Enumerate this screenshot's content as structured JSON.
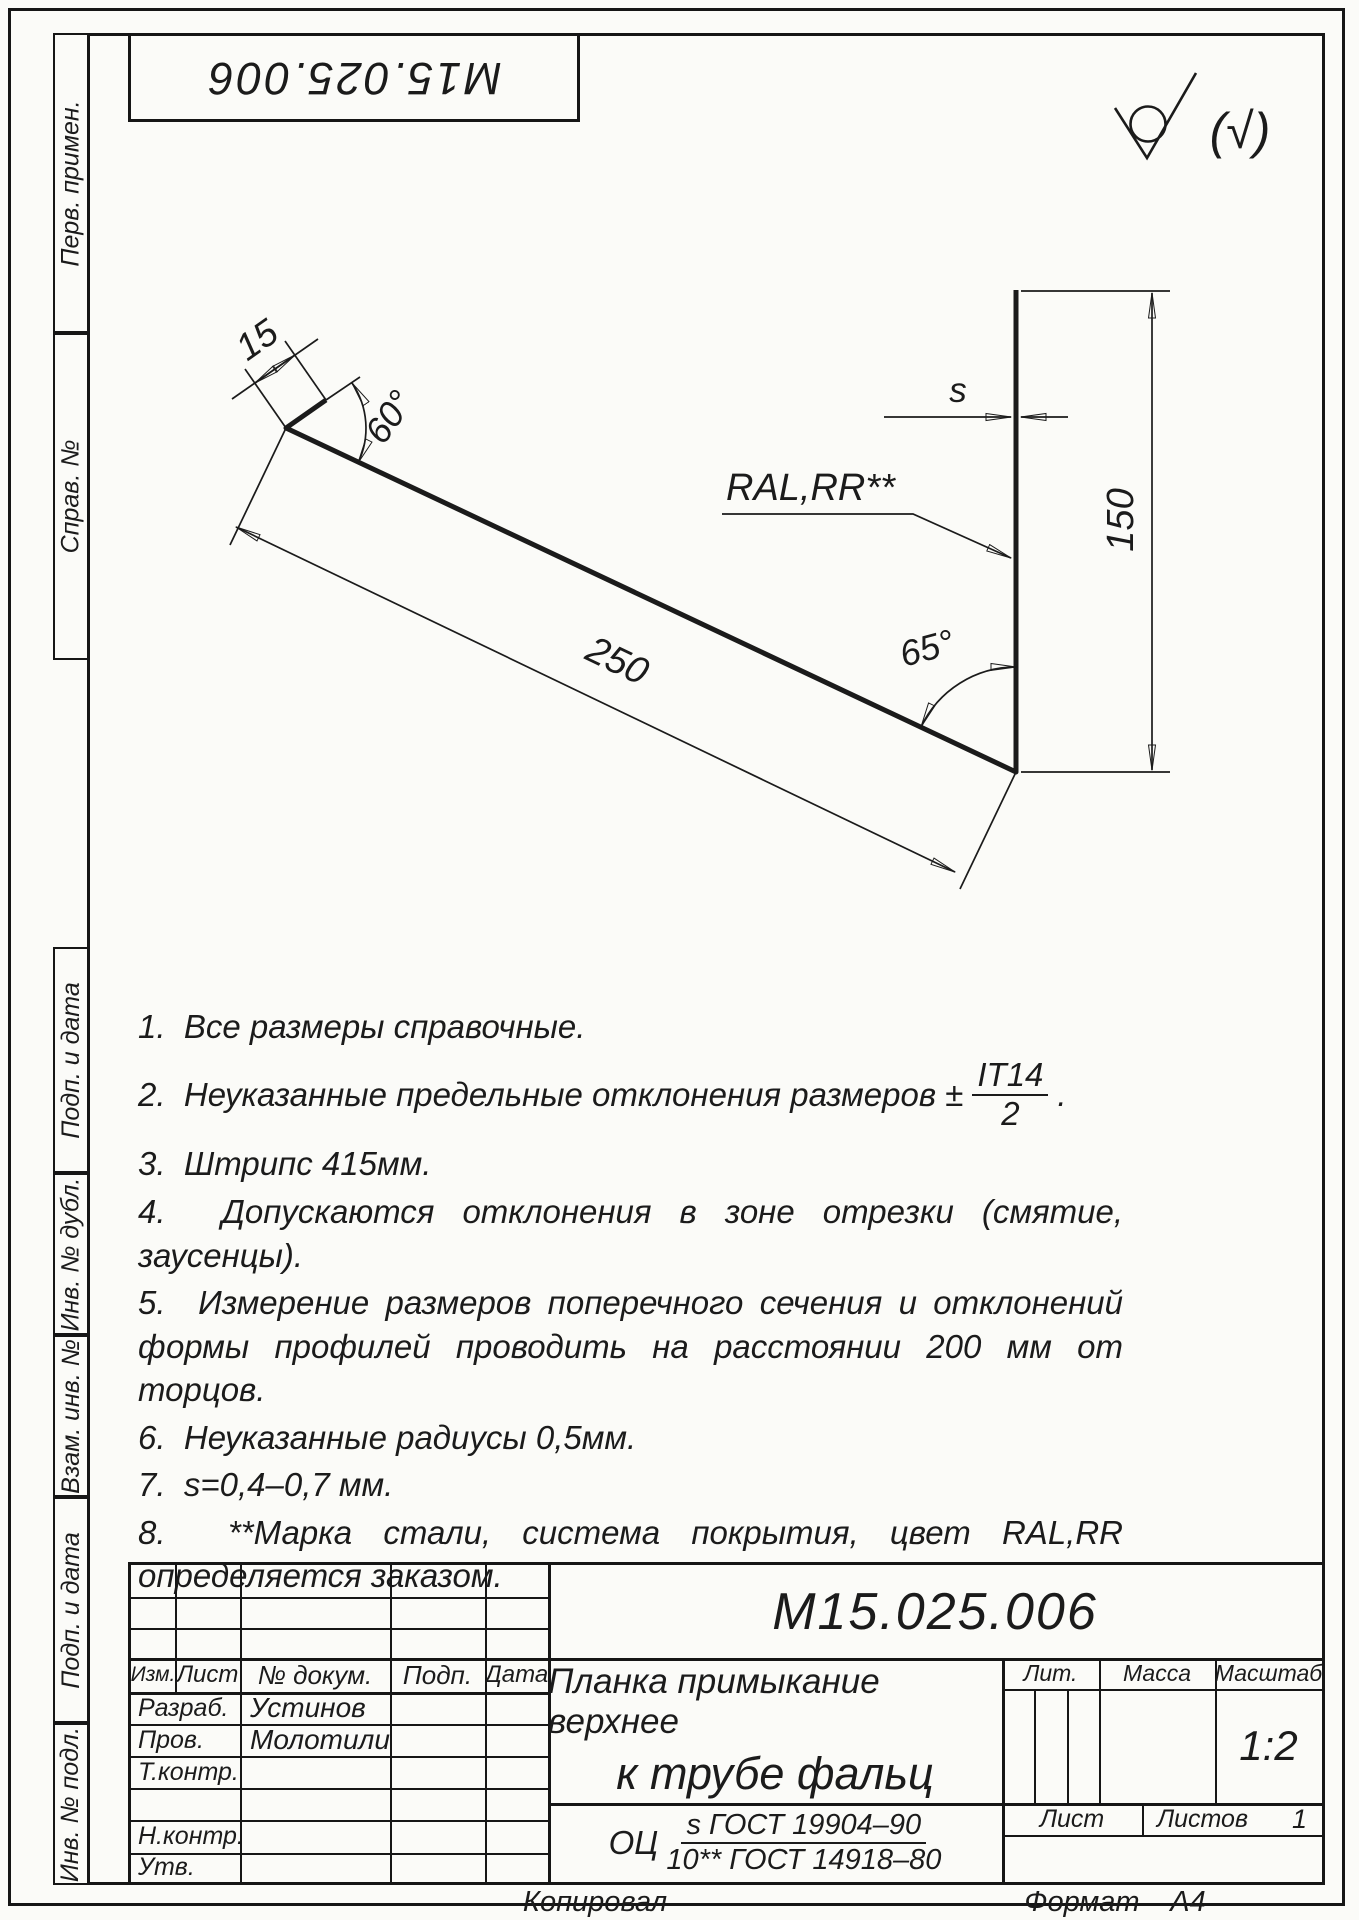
{
  "page": {
    "background": "#fbfbf8",
    "ink": "#1b1b1b"
  },
  "corner_stamp": {
    "number": "М15.025.006"
  },
  "roughness": {
    "paren_mark": "(√)"
  },
  "margin_labels": {
    "perv_primen": "Перв. примен.",
    "sprav_no": "Справ. №",
    "podp_i_data_upper": "Подп. и дата",
    "inv_no_dubl": "Инв. № дубл.",
    "vzam_inv_no": "Взам. инв. №",
    "podp_i_data_lower": "Подп. и дата",
    "inv_no_podl": "Инв. № подл."
  },
  "drawing": {
    "dim_flange": "15",
    "dim_angle_top": "60°",
    "dim_length": "250",
    "dim_angle_bottom": "65°",
    "dim_thickness": "s",
    "dim_height": "150",
    "coating_label": "RAL,RR**"
  },
  "notes": [
    {
      "text": "1.  Все размеры справочные."
    },
    {
      "prefix": "2.  Неуказанные предельные отклонения размеров ±",
      "frac_num": "IT14",
      "frac_den": "2",
      "suffix": "."
    },
    {
      "text": "3.  Штрипс 415мм."
    },
    {
      "text": "4.  Допускаются отклонения в зоне отрезки (смятие, заусенцы)."
    },
    {
      "text": "5.  Измерение размеров поперечного сечения и отклонений формы профилей проводить на расстоянии 200 мм от торцов."
    },
    {
      "text": "6.  Неуказанные радиусы 0,5мм."
    },
    {
      "text": "7.  s=0,4–0,7 мм."
    },
    {
      "text": "8.  **Марка стали, система покрытия, цвет RAL,RR определяется заказом."
    }
  ],
  "title_block": {
    "doc_number": "М15.025.006",
    "product_name_line1": "Планка примыкание верхнее",
    "product_name_line2": "к трубе фальц",
    "material_prefix": "ОЦ",
    "material_frac_num": "s ГОСТ 19904–90",
    "material_frac_den": "10** ГОСТ 14918–80",
    "col_izm": "Изм.",
    "col_list": "Лист",
    "col_ndoc": "№ докум.",
    "col_podp": "Подп.",
    "col_data": "Дата",
    "row_razrab": "Разраб.",
    "row_razrab_name": "Устинов",
    "row_prov": "Пров.",
    "row_prov_name": "Молотилин",
    "row_tkontr": "Т.контр.",
    "row_nkontr": "Н.контр.",
    "row_utv": "Утв.",
    "lit_label": "Лит.",
    "massa_label": "Масса",
    "masshtab_label": "Масштаб",
    "scale_value": "1:2",
    "list_label": "Лист",
    "listov_label": "Листов",
    "listov_value": "1"
  },
  "footer": {
    "kopiroval": "Копировал",
    "format_label": "Формат",
    "format_value": "А4"
  }
}
